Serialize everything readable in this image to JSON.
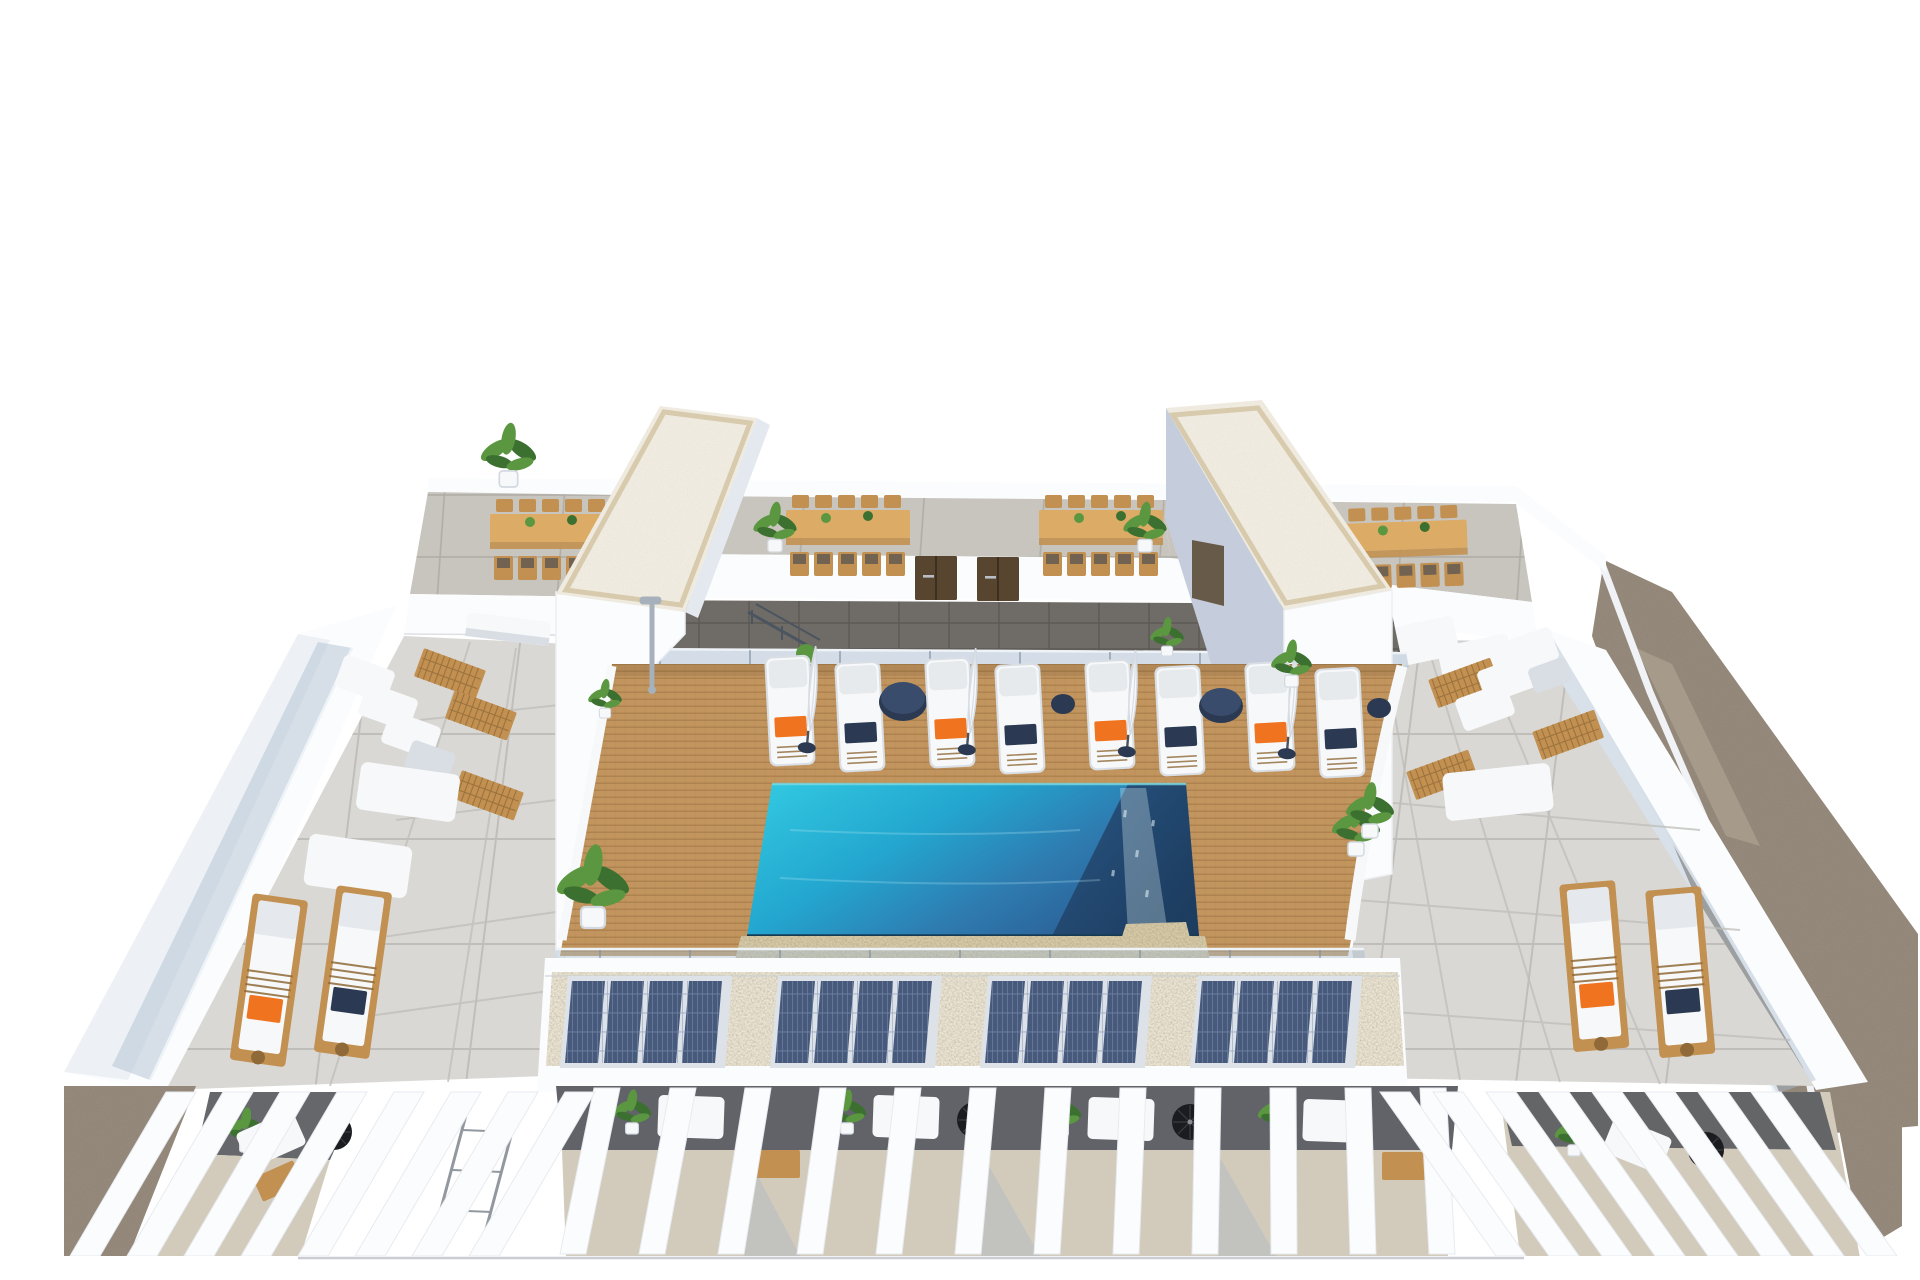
{
  "title": "Aerial 3D architectural rendering of a residential rooftop terrace with infinity pool",
  "scene": {
    "areas": [
      {
        "label": "rooftop dining terrace with two stair towers"
      },
      {
        "label": "central teak pool deck with sun loungers"
      },
      {
        "label": "infinity swimming pool"
      },
      {
        "label": "left lounge wing with sofas and teak loungers"
      },
      {
        "label": "right lounge wing with sofas and teak loungers"
      },
      {
        "label": "solar panel parapet strip"
      },
      {
        "label": "lower pergola terraces with white fins"
      },
      {
        "label": "gravel border along the right edge"
      }
    ]
  },
  "inventory": {
    "stair_towers": 2,
    "service_doors": 2,
    "dining_sets": 4,
    "pool_loungers": 8,
    "pool_umbrellas": 4,
    "poolside_tables": 4,
    "wing_teak_loungers": 4,
    "solar_arrays": 4,
    "solar_modules_per_array": 4,
    "pergola_fins": {
      "left": 8,
      "center": 12,
      "right": 8
    }
  },
  "colors": {
    "bg": "#ffffff",
    "wall": "#fbfcfd",
    "wall_shade": "#e4e9f0",
    "wall_edge": "#d3d9e2",
    "tower_shade": "#c5cddc",
    "roof": "#f0ebe0",
    "roof_trim": "#d8caac",
    "terrace": "#c8c5bf",
    "terrace_joint": "#b0ada7",
    "walkway": "#6f6b66",
    "walkway_joint": "#5c5854",
    "door": "#57452f",
    "deck": "#c2955e",
    "deck_line": "#9d7543",
    "pool_aqua": "#33cbe2",
    "pool_mid": "#23a6cf",
    "pool_blue": "#2e7cb1",
    "pool_deep": "#2b5f95",
    "pool_navy1": "#27517d",
    "pool_navy2": "#1c3a5c",
    "pool_spark": "#e8f7fa",
    "pool_stone": "#d7caa6",
    "pool_edge": "#163c55",
    "concrete": "#d9d8d4",
    "concrete_joint": "#bfbeba",
    "glass": "#a9bccf",
    "glass_edge": "#eef3f8",
    "glass_post": "#7e8ea0",
    "gravel": "#95897b",
    "gravel_light": "#a99d8e",
    "solar_bed": "#ece5d3",
    "solar_cell": "#475a7c",
    "solar_grid": "#8194b4",
    "solar_frame": "#dde2e9",
    "furn_white": "#f7f8f9",
    "furn_shade": "#d9dee4",
    "orange": "#f0731f",
    "navy": "#2b3a52",
    "teak": "#c29051",
    "teak_dark": "#8f6a38",
    "table_wood": "#dcab66",
    "green": "#5a9740",
    "green_dark": "#3c7030",
    "stone_floor": "#d2cbbc",
    "charcoal": "#54565b",
    "black": "#1b1c1f",
    "fin_shade": "#dce1e9",
    "shadow_blue": "#9fb1c6",
    "chrome": "#a7b1bb",
    "rail": "#4b5560",
    "line_grey": "#c9cdd3"
  }
}
